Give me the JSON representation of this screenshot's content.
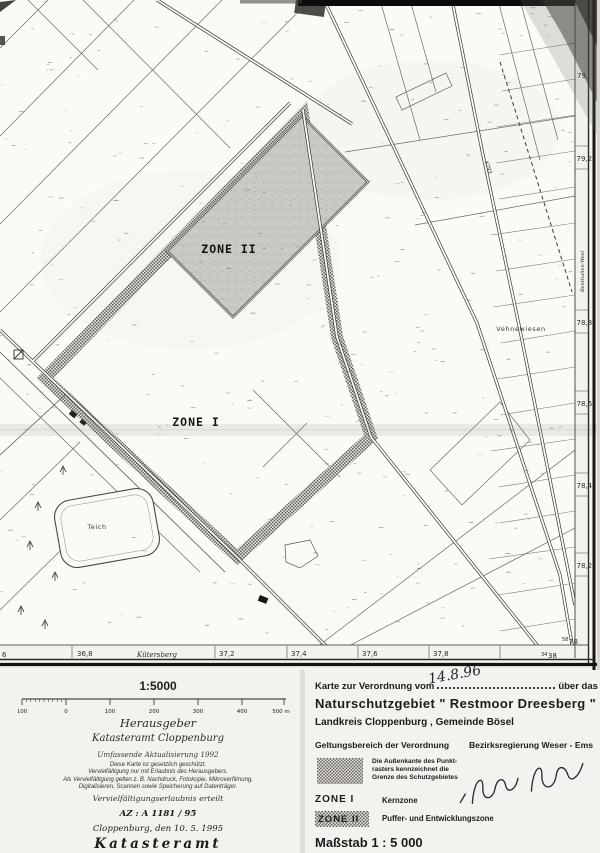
{
  "map": {
    "zone2_label": "ZONE II",
    "zone1_label": "ZONE I",
    "meadow_label": "Vehnewiesen",
    "pond_label": "Teich",
    "road_label": "K293",
    "ridge_label": "Kütersberg",
    "right_edge": {
      "partial_top": "79,",
      "labels": [
        "79,2",
        "78,8",
        "78,6",
        "78,4",
        "78,2"
      ],
      "vertical_label": "Benthullen-West",
      "grid_small": "58",
      "grid_big": "78"
    },
    "bottom_edge": {
      "partial_left": "6",
      "labels": [
        "36,8",
        "37,2",
        "37,4",
        "37,6",
        "37,8"
      ],
      "grid_small": "34",
      "grid_big": "38"
    }
  },
  "footer_left": {
    "scale_title": "1:5000",
    "scale_ticks": [
      "100",
      "0",
      "100",
      "200",
      "300",
      "400",
      "500 m"
    ],
    "publisher_heading": "Herausgeber",
    "publisher_name": "Katasteramt Cloppenburg",
    "update_note": "Umfassende Aktualisierung 1992",
    "copyright_lines": [
      "Diese Karte ist gesetzlich geschützt.",
      "Vervielfältigung nur mit Erlaubnis des Herausgebers.",
      "Als Vervielfältigung gelten z. B. Nachdruck, Fotokopie, Mikroverfilmung,",
      "Digitalisieren, Scannen sowie Speicherung auf Datenträger."
    ],
    "permission_note": "Vervielfältigungserlaubnis erteilt",
    "file_number": "AZ : A 1181 / 95",
    "place_date": "Cloppenburg, den 10. 5. 1995",
    "office_name": "Katasteramt"
  },
  "footer_right": {
    "decree_prefix": "Karte zur Verordnung  vom",
    "decree_date": "14.8.96",
    "decree_suffix": "über das",
    "area_title": "Naturschutzgebiet  \" Restmoor Dreesberg \"",
    "area_subtitle": "Landkreis Cloppenburg , Gemeinde Bösel",
    "scope_label": "Geltungsbereich der Verordnung",
    "authority_label": "Bezirksregierung Weser - Ems",
    "raster_note_lines": [
      "Die Außenkante des Punkt-",
      "rasters kennzeichnet die",
      "Grenze des Schutzgebietes"
    ],
    "zone1_key": "ZONE  I",
    "zone1_desc": "Kernzone",
    "zone2_key": "ZONE II",
    "zone2_desc": "Puffer- und  Entwicklungszone",
    "scale_statement": "Maßstab  1 : 5 000"
  }
}
